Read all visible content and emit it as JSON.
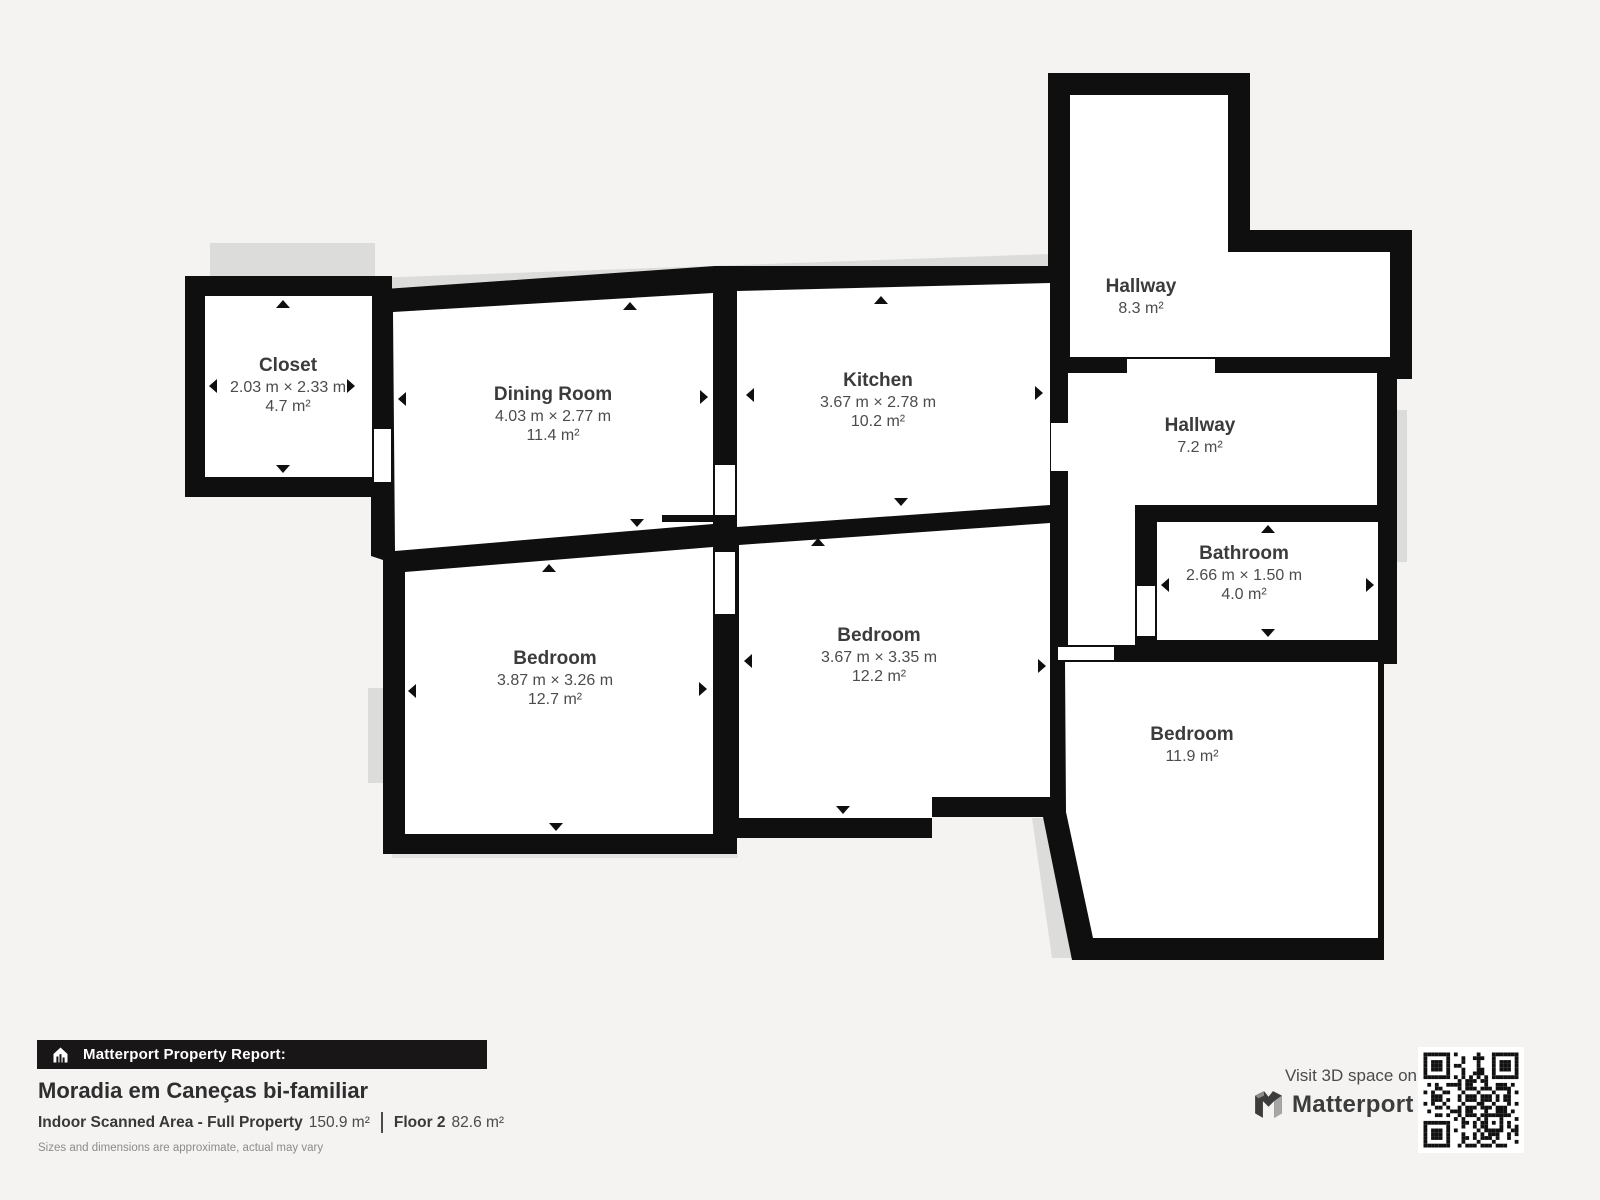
{
  "colors": {
    "background": "#f4f3f1",
    "wall": "#0f0f0f",
    "room_fill": "#ffffff",
    "shadow": "#dcdcda",
    "banner_bg": "#181616",
    "text_dark": "#3b3b3b"
  },
  "rooms": {
    "closet": {
      "name": "Closet",
      "dims": "2.03 m × 2.33 m",
      "area": "4.7 m²"
    },
    "dining": {
      "name": "Dining Room",
      "dims": "4.03 m × 2.77 m",
      "area": "11.4 m²"
    },
    "kitchen": {
      "name": "Kitchen",
      "dims": "3.67 m × 2.78 m",
      "area": "10.2 m²"
    },
    "hallway_top": {
      "name": "Hallway",
      "area": "8.3 m²"
    },
    "hallway_mid": {
      "name": "Hallway",
      "area": "7.2 m²"
    },
    "bathroom": {
      "name": "Bathroom",
      "dims": "2.66 m × 1.50 m",
      "area": "4.0 m²"
    },
    "bedroom_left": {
      "name": "Bedroom",
      "dims": "3.87 m × 3.26 m",
      "area": "12.7 m²"
    },
    "bedroom_mid": {
      "name": "Bedroom",
      "dims": "3.67 m × 3.35 m",
      "area": "12.2 m²"
    },
    "bedroom_right": {
      "name": "Bedroom",
      "area": "11.9 m²"
    }
  },
  "report": {
    "banner": "Matterport Property Report:",
    "title": "Moradia em Caneças bi-familiar",
    "scanned_label": "Indoor Scanned Area - Full Property",
    "scanned_value": "150.9 m²",
    "floor_label": "Floor 2",
    "floor_value": "82.6 m²",
    "disclaimer": "Sizes and dimensions are approximate, actual may vary"
  },
  "footer_right": {
    "visit": "Visit 3D space on",
    "brand": "Matterport"
  }
}
